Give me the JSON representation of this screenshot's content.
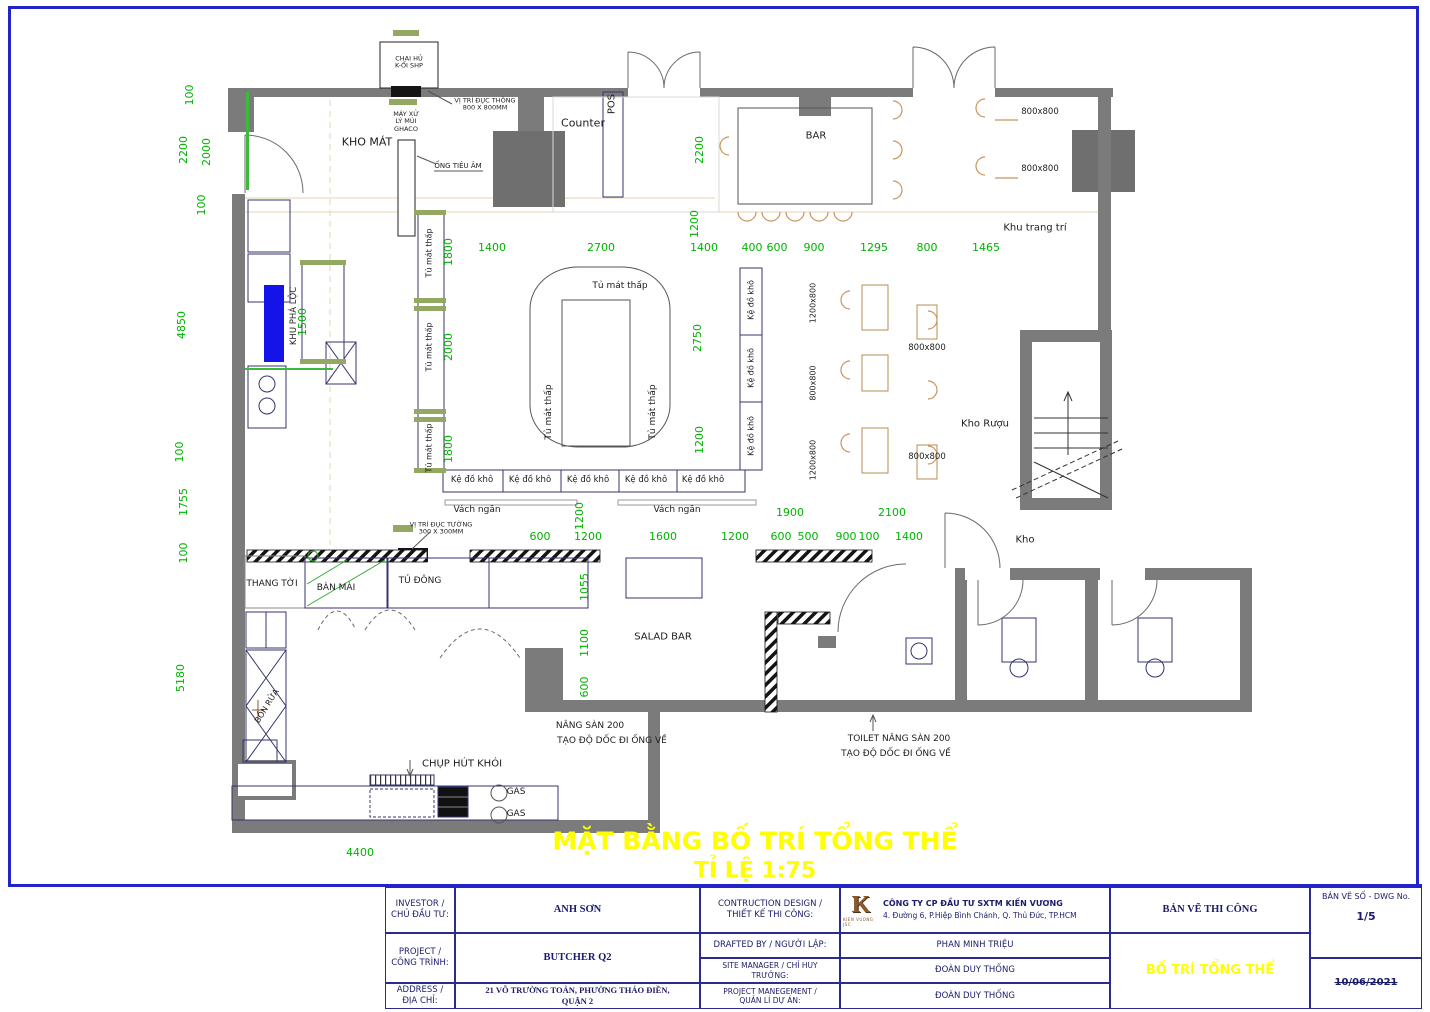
{
  "sheet": {
    "plan_title": "MẶT BẰNG BỐ TRÍ TỔNG THỂ",
    "plan_scale": "TỈ LỆ 1:75"
  },
  "colors": {
    "dimension_green": "#00B300",
    "wall_gray": "#7B7B7B",
    "highlight_blue": "#1414E8",
    "title_yellow": "#FFFF00",
    "frame_blue": "#2323CC",
    "logo_brown": "#8A5A2B"
  },
  "plan": {
    "labels": [
      {
        "t": "Counter",
        "x": 583,
        "y": 124,
        "fs": 11
      },
      {
        "t": "POS",
        "x": 612,
        "y": 104,
        "r": -90,
        "fs": 10
      },
      {
        "t": "BAR",
        "x": 816,
        "y": 136,
        "fs": 10
      },
      {
        "t": "KHO MÁT",
        "x": 367,
        "y": 143,
        "fs": 11
      },
      {
        "t": "Khu trang trí",
        "x": 1035,
        "y": 228,
        "fs": 10
      },
      {
        "t": "Kho Rượu",
        "x": 985,
        "y": 424,
        "fs": 10
      },
      {
        "t": "Kho",
        "x": 1025,
        "y": 540,
        "fs": 10
      },
      {
        "t": "SALAD BAR",
        "x": 663,
        "y": 637,
        "fs": 10
      },
      {
        "t": "THANG TỜI",
        "x": 272,
        "y": 584,
        "fs": 9
      },
      {
        "t": "BÀN MÁI",
        "x": 336,
        "y": 588,
        "fs": 9
      },
      {
        "t": "TỦ ĐÔNG",
        "x": 420,
        "y": 581,
        "fs": 9
      },
      {
        "t": "Tủ mát thấp",
        "x": 620,
        "y": 286,
        "fs": 9
      },
      {
        "t": "Tủ mát thấp",
        "x": 549,
        "y": 412,
        "r": -90,
        "fs": 9
      },
      {
        "t": "Tủ mát thấp",
        "x": 653,
        "y": 412,
        "r": -90,
        "fs": 9
      },
      {
        "t": "Tủ mát thấp",
        "x": 429,
        "y": 253,
        "r": -90,
        "fs": 8
      },
      {
        "t": "Tủ mát thấp",
        "x": 429,
        "y": 347,
        "r": -90,
        "fs": 8
      },
      {
        "t": "Tủ mát thấp",
        "x": 429,
        "y": 448,
        "r": -90,
        "fs": 8
      },
      {
        "t": "Kệ đồ khô",
        "x": 472,
        "y": 481,
        "fs": 8.5
      },
      {
        "t": "Kệ đồ khô",
        "x": 530,
        "y": 481,
        "fs": 8.5
      },
      {
        "t": "Kệ đồ khô",
        "x": 588,
        "y": 481,
        "fs": 8.5
      },
      {
        "t": "Kệ đồ khô",
        "x": 646,
        "y": 481,
        "fs": 8.5
      },
      {
        "t": "Kệ đồ khô",
        "x": 703,
        "y": 481,
        "fs": 8.5
      },
      {
        "t": "Kệ đồ khô",
        "x": 751,
        "y": 300,
        "r": -90,
        "fs": 8
      },
      {
        "t": "Kệ đồ khô",
        "x": 751,
        "y": 368,
        "r": -90,
        "fs": 8
      },
      {
        "t": "Kệ đồ khô",
        "x": 751,
        "y": 436,
        "r": -90,
        "fs": 8
      },
      {
        "t": "Vách ngăn",
        "x": 477,
        "y": 510,
        "fs": 9
      },
      {
        "t": "Vách ngăn",
        "x": 677,
        "y": 510,
        "fs": 9
      },
      {
        "t": "KHU PHÁ LỘC",
        "x": 295,
        "y": 316,
        "r": -90,
        "fs": 8.5
      },
      {
        "t": "BỒN RỬA",
        "x": 267,
        "y": 706,
        "r": -58,
        "fs": 8
      },
      {
        "t": "CHỤP HÚT KHÓI",
        "x": 462,
        "y": 764,
        "fs": 10
      },
      {
        "t": "GAS",
        "x": 516,
        "y": 792,
        "fs": 9
      },
      {
        "t": "GAS",
        "x": 516,
        "y": 814,
        "fs": 9
      },
      {
        "t": "CHAI HỦ\nK-ỔI SHP",
        "x": 409,
        "y": 63,
        "fs": 6.5
      },
      {
        "t": "VỊ TRÍ ĐỤC THÔNG\n800 X 800MM",
        "x": 485,
        "y": 105,
        "fs": 6.5
      },
      {
        "t": "MÁY XỬ\nLÝ MÙI\nGHACO",
        "x": 406,
        "y": 122,
        "fs": 6.5
      },
      {
        "t": "ỐNG TIÊU ÂM",
        "x": 458,
        "y": 166,
        "fs": 7
      },
      {
        "t": "VỊ TRÍ ĐỤC TƯỜNG\n300 X 300MM",
        "x": 441,
        "y": 529,
        "fs": 6.5
      },
      {
        "t": "NÂNG SÀN 200",
        "x": 590,
        "y": 726,
        "fs": 9
      },
      {
        "t": "TẠO ĐỘ DỐC ĐI ỐNG VỀ",
        "x": 612,
        "y": 741,
        "fs": 9
      },
      {
        "t": "TOILET NÂNG SÀN 200",
        "x": 899,
        "y": 739,
        "fs": 9
      },
      {
        "t": "TẠO ĐỘ DỐC ĐI ỐNG VỀ",
        "x": 896,
        "y": 754,
        "fs": 9
      },
      {
        "t": "800x800",
        "x": 1040,
        "y": 113,
        "fs": 8.5
      },
      {
        "t": "800x800",
        "x": 1040,
        "y": 170,
        "fs": 8.5
      },
      {
        "t": "1200x800",
        "x": 813,
        "y": 303,
        "r": -90,
        "fs": 8
      },
      {
        "t": "800x800",
        "x": 813,
        "y": 383,
        "r": -90,
        "fs": 8
      },
      {
        "t": "1200x800",
        "x": 813,
        "y": 460,
        "r": -90,
        "fs": 8
      },
      {
        "t": "800x800",
        "x": 927,
        "y": 349,
        "fs": 8.5
      },
      {
        "t": "800x800",
        "x": 927,
        "y": 458,
        "fs": 8.5
      }
    ],
    "dims": [
      {
        "t": "100",
        "x": 190,
        "y": 95,
        "r": -90
      },
      {
        "t": "2200",
        "x": 184,
        "y": 150,
        "r": -90
      },
      {
        "t": "2000",
        "x": 207,
        "y": 152,
        "r": -90
      },
      {
        "t": "100",
        "x": 202,
        "y": 205,
        "r": -90
      },
      {
        "t": "4850",
        "x": 182,
        "y": 325,
        "r": -90
      },
      {
        "t": "1500",
        "x": 303,
        "y": 322,
        "r": -90
      },
      {
        "t": "100",
        "x": 180,
        "y": 452,
        "r": -90
      },
      {
        "t": "1755",
        "x": 184,
        "y": 502,
        "r": -90
      },
      {
        "t": "100",
        "x": 184,
        "y": 553,
        "r": -90
      },
      {
        "t": "5180",
        "x": 181,
        "y": 678,
        "r": -90
      },
      {
        "t": "1400",
        "x": 492,
        "y": 248
      },
      {
        "t": "2700",
        "x": 601,
        "y": 248
      },
      {
        "t": "1400",
        "x": 704,
        "y": 248
      },
      {
        "t": "400",
        "x": 752,
        "y": 248
      },
      {
        "t": "600",
        "x": 777,
        "y": 248
      },
      {
        "t": "900",
        "x": 814,
        "y": 248
      },
      {
        "t": "1295",
        "x": 874,
        "y": 248
      },
      {
        "t": "800",
        "x": 927,
        "y": 248
      },
      {
        "t": "1465",
        "x": 986,
        "y": 248
      },
      {
        "t": "2200",
        "x": 700,
        "y": 150,
        "r": -90
      },
      {
        "t": "1200",
        "x": 695,
        "y": 224,
        "r": -90
      },
      {
        "t": "2750",
        "x": 698,
        "y": 338,
        "r": -90
      },
      {
        "t": "1200",
        "x": 700,
        "y": 440,
        "r": -90
      },
      {
        "t": "1800",
        "x": 449,
        "y": 252,
        "r": -90
      },
      {
        "t": "2000",
        "x": 449,
        "y": 347,
        "r": -90
      },
      {
        "t": "1800",
        "x": 449,
        "y": 449,
        "r": -90
      },
      {
        "t": "1200",
        "x": 580,
        "y": 516,
        "r": -90
      },
      {
        "t": "600",
        "x": 540,
        "y": 537
      },
      {
        "t": "1200",
        "x": 588,
        "y": 537
      },
      {
        "t": "1600",
        "x": 663,
        "y": 537
      },
      {
        "t": "1200",
        "x": 735,
        "y": 537
      },
      {
        "t": "600",
        "x": 781,
        "y": 537
      },
      {
        "t": "500",
        "x": 808,
        "y": 537
      },
      {
        "t": "900",
        "x": 846,
        "y": 537
      },
      {
        "t": "100",
        "x": 869,
        "y": 537
      },
      {
        "t": "1400",
        "x": 909,
        "y": 537
      },
      {
        "t": "1900",
        "x": 790,
        "y": 513
      },
      {
        "t": "2100",
        "x": 892,
        "y": 513
      },
      {
        "t": "1055",
        "x": 585,
        "y": 587,
        "r": -90
      },
      {
        "t": "1100",
        "x": 585,
        "y": 643,
        "r": -90
      },
      {
        "t": "600",
        "x": 585,
        "y": 687,
        "r": -90
      },
      {
        "t": "4400",
        "x": 360,
        "y": 853
      }
    ]
  },
  "title_block": {
    "investor_label": "INVESTOR /\nCHỦ ĐẦU TƯ:",
    "investor_value": "ANH SƠN",
    "project_label": "PROJECT /\nCÔNG TRÌNH:",
    "project_value": "BUTCHER Q2",
    "address_label": "ADDRESS /\nĐỊA CHỈ:",
    "address_value": "21 VÕ TRƯỜNG TOẢN, PHƯỜNG THẢO ĐIỀN,\nQUẬN 2",
    "design_label": "CONTRUCTION DESIGN /\nTHIẾT KẾ THI CÔNG:",
    "drafted_label": "DRAFTED BY / NGƯỜI LẬP:",
    "site_label": "SITE MANAGER / CHỈ HUY\nTRƯỞNG:",
    "pm_label": "PROJECT MANEGEMENT /\nQUẢN LÍ DỰ ÁN:",
    "company_name": "CÔNG TY CP ĐẦU TƯ SXTM KIẾN VƯƠNG",
    "company_address": "4. Đường 6, P.Hiệp Bình Chánh, Q. Thủ Đức, TP.HCM",
    "drafted_value": "PHAN MINH TRIỆU",
    "site_value": "ĐOÀN DUY THỐNG",
    "pm_value": "ĐOÀN DUY THỐNG",
    "sheet_type": "BẢN VẼ THI CÔNG",
    "sheet_title": "BỐ TRÍ TỔNG THỂ",
    "dwg_label": "BẢN VẼ SỐ - DWG No.",
    "dwg_no": "1/5",
    "date": "10/06/2021",
    "logo_letter": "K",
    "logo_caption": "KIEN VUONG JSC"
  }
}
